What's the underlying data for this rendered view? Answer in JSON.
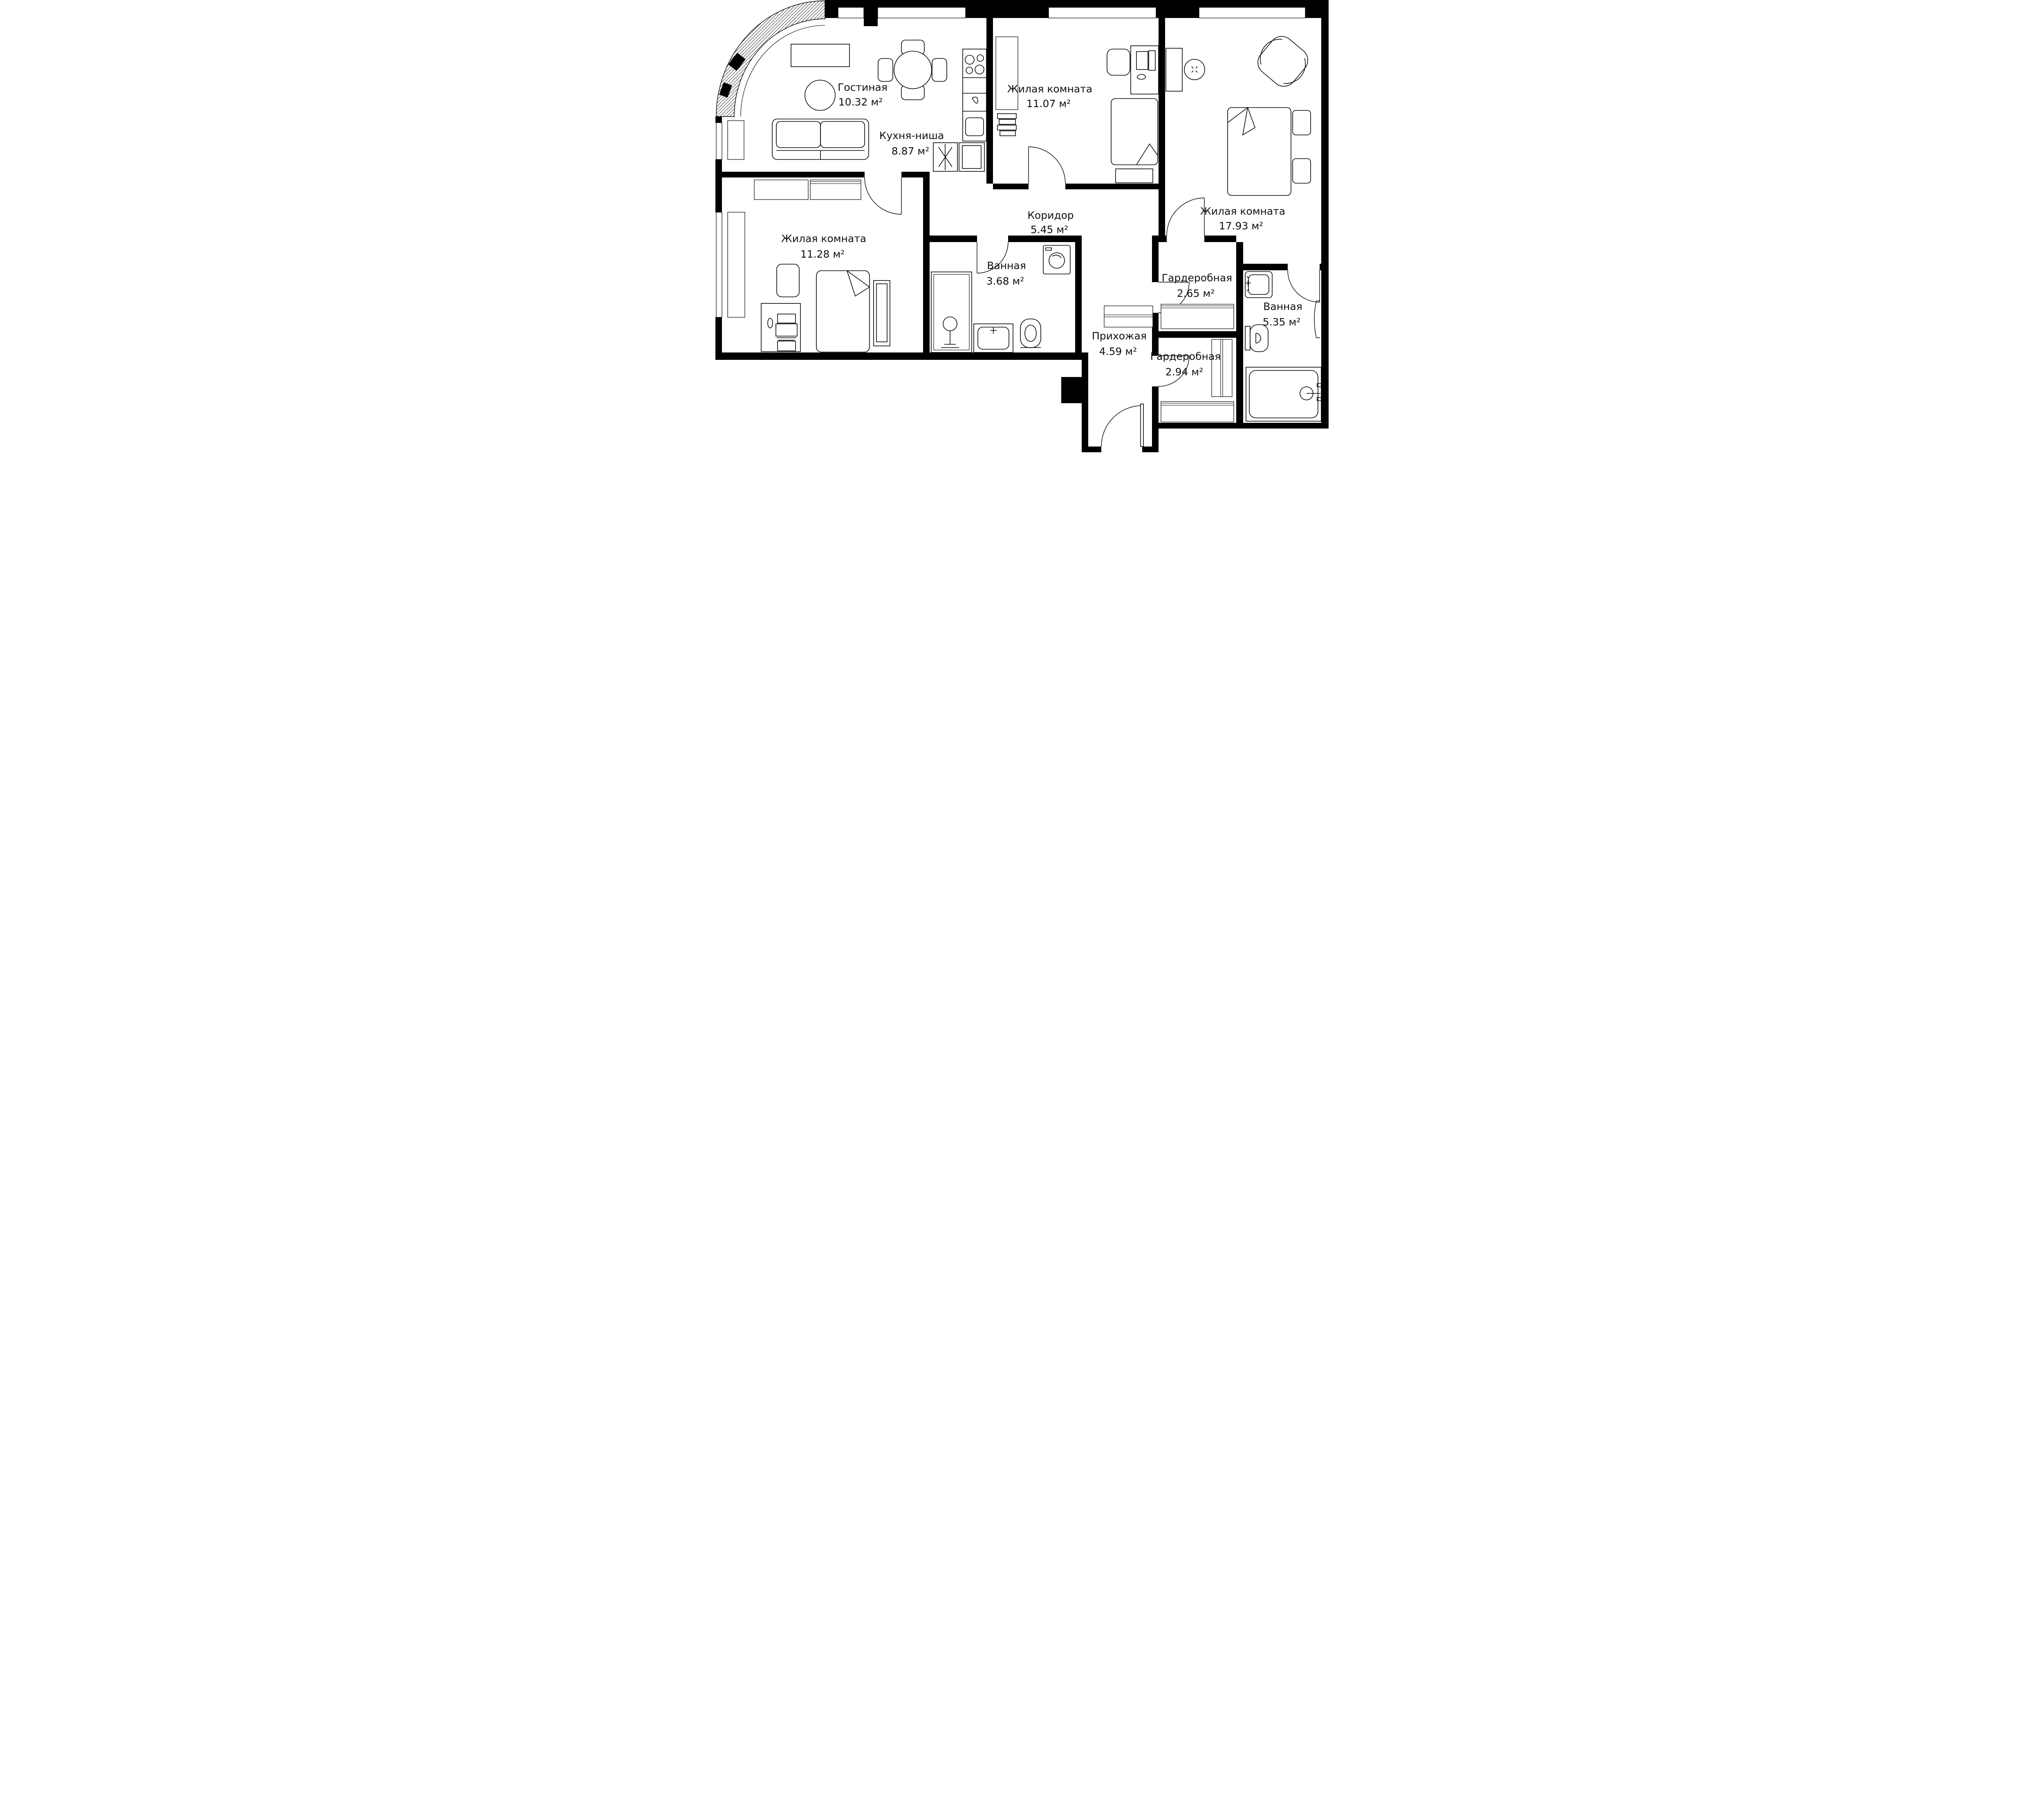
{
  "plan": {
    "type": "apartment-floor-plan",
    "background_color": "#ffffff",
    "wall_color": "#000000",
    "line_color": "#000000",
    "text_color": "#111111",
    "unit_suffix": "м²",
    "rooms": [
      {
        "name": "Гостиная",
        "area": "10.32 м²"
      },
      {
        "name": "Кухня-ниша",
        "area": "8.87 м²"
      },
      {
        "name": "Жилая комната",
        "area": "11.07 м²"
      },
      {
        "name": "Жилая комната",
        "area": "17.93 м²"
      },
      {
        "name": "Жилая комната",
        "area": "11.28 м²"
      },
      {
        "name": "Коридор",
        "area": "5.45 м²"
      },
      {
        "name": "Ванная",
        "area": "3.68 м²"
      },
      {
        "name": "Прихожая",
        "area": "4.59 м²"
      },
      {
        "name": "Гардеробная",
        "area": "2.65 м²"
      },
      {
        "name": "Ванная",
        "area": "5.35 м²"
      },
      {
        "name": "Гардеробная",
        "area": "2.94 м²"
      }
    ]
  }
}
